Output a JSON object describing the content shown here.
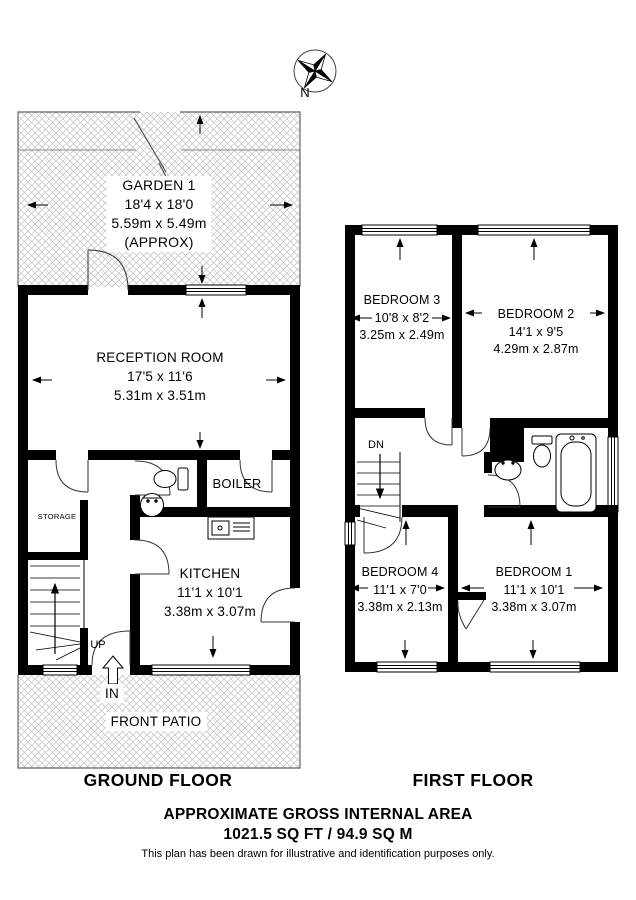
{
  "compass": {
    "north_label": "N"
  },
  "ground_floor": {
    "title": "GROUND FLOOR",
    "garden": {
      "name": "GARDEN 1",
      "dims_imperial": "18'4 x 18'0",
      "dims_metric": "5.59m x 5.49m",
      "note": "(APPROX)"
    },
    "reception": {
      "name": "RECEPTION ROOM",
      "dims_imperial": "17'5 x 11'6",
      "dims_metric": "5.31m x 3.51m"
    },
    "storage": {
      "name": "STORAGE"
    },
    "boiler": {
      "name": "BOILER"
    },
    "kitchen": {
      "name": "KITCHEN",
      "dims_imperial": "11'1 x 10'1",
      "dims_metric": "3.38m x 3.07m"
    },
    "stairs_label": "UP",
    "entrance_label": "IN",
    "patio": {
      "name": "FRONT PATIO"
    }
  },
  "first_floor": {
    "title": "FIRST FLOOR",
    "bedroom3": {
      "name": "BEDROOM 3",
      "dims_imperial": "10'8 x 8'2",
      "dims_metric": "3.25m x 2.49m"
    },
    "bedroom2": {
      "name": "BEDROOM 2",
      "dims_imperial": "14'1 x 9'5",
      "dims_metric": "4.29m x 2.87m"
    },
    "bedroom4": {
      "name": "BEDROOM 4",
      "dims_imperial": "11'1 x 7'0",
      "dims_metric": "3.38m x 2.13m"
    },
    "bedroom1": {
      "name": "BEDROOM 1",
      "dims_imperial": "11'1 x 10'1",
      "dims_metric": "3.38m x 3.07m"
    },
    "stairs_label": "DN"
  },
  "footer": {
    "title": "APPROXIMATE GROSS INTERNAL AREA",
    "area": "1021.5 SQ FT / 94.9 SQ M",
    "disclaimer": "This plan has been drawn for illustrative and identification purposes only."
  }
}
